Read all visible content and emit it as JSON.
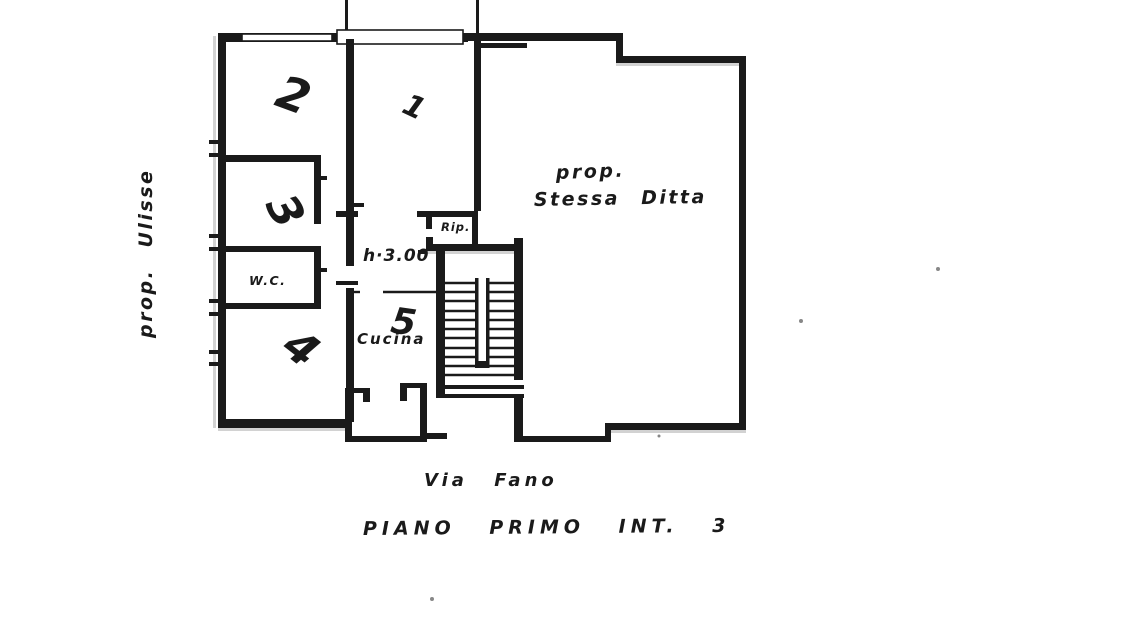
{
  "page": {
    "background_color": "#ffffff",
    "ink_color": "#1f1f1f",
    "type_note": "scanned floor plan drawing"
  },
  "annotations": {
    "owner_left_vertical": "prop. Ulisse",
    "owner_big_room_line1": "prop.",
    "owner_big_room_line2": "Stessa Ditta",
    "ceiling_height": "h·3.00"
  },
  "rooms": {
    "hall_number": "1",
    "room_top_left_number": "2",
    "room_mid_left_number": "3",
    "room_bottom_left_number": "4",
    "kitchen_number": "5",
    "wc_label": "W.C.",
    "closet_label": "Rip.",
    "kitchen_label": "Cucina"
  },
  "footer": {
    "street": "Via Fano",
    "floor": "PIANO PRIMO INT. 3"
  }
}
